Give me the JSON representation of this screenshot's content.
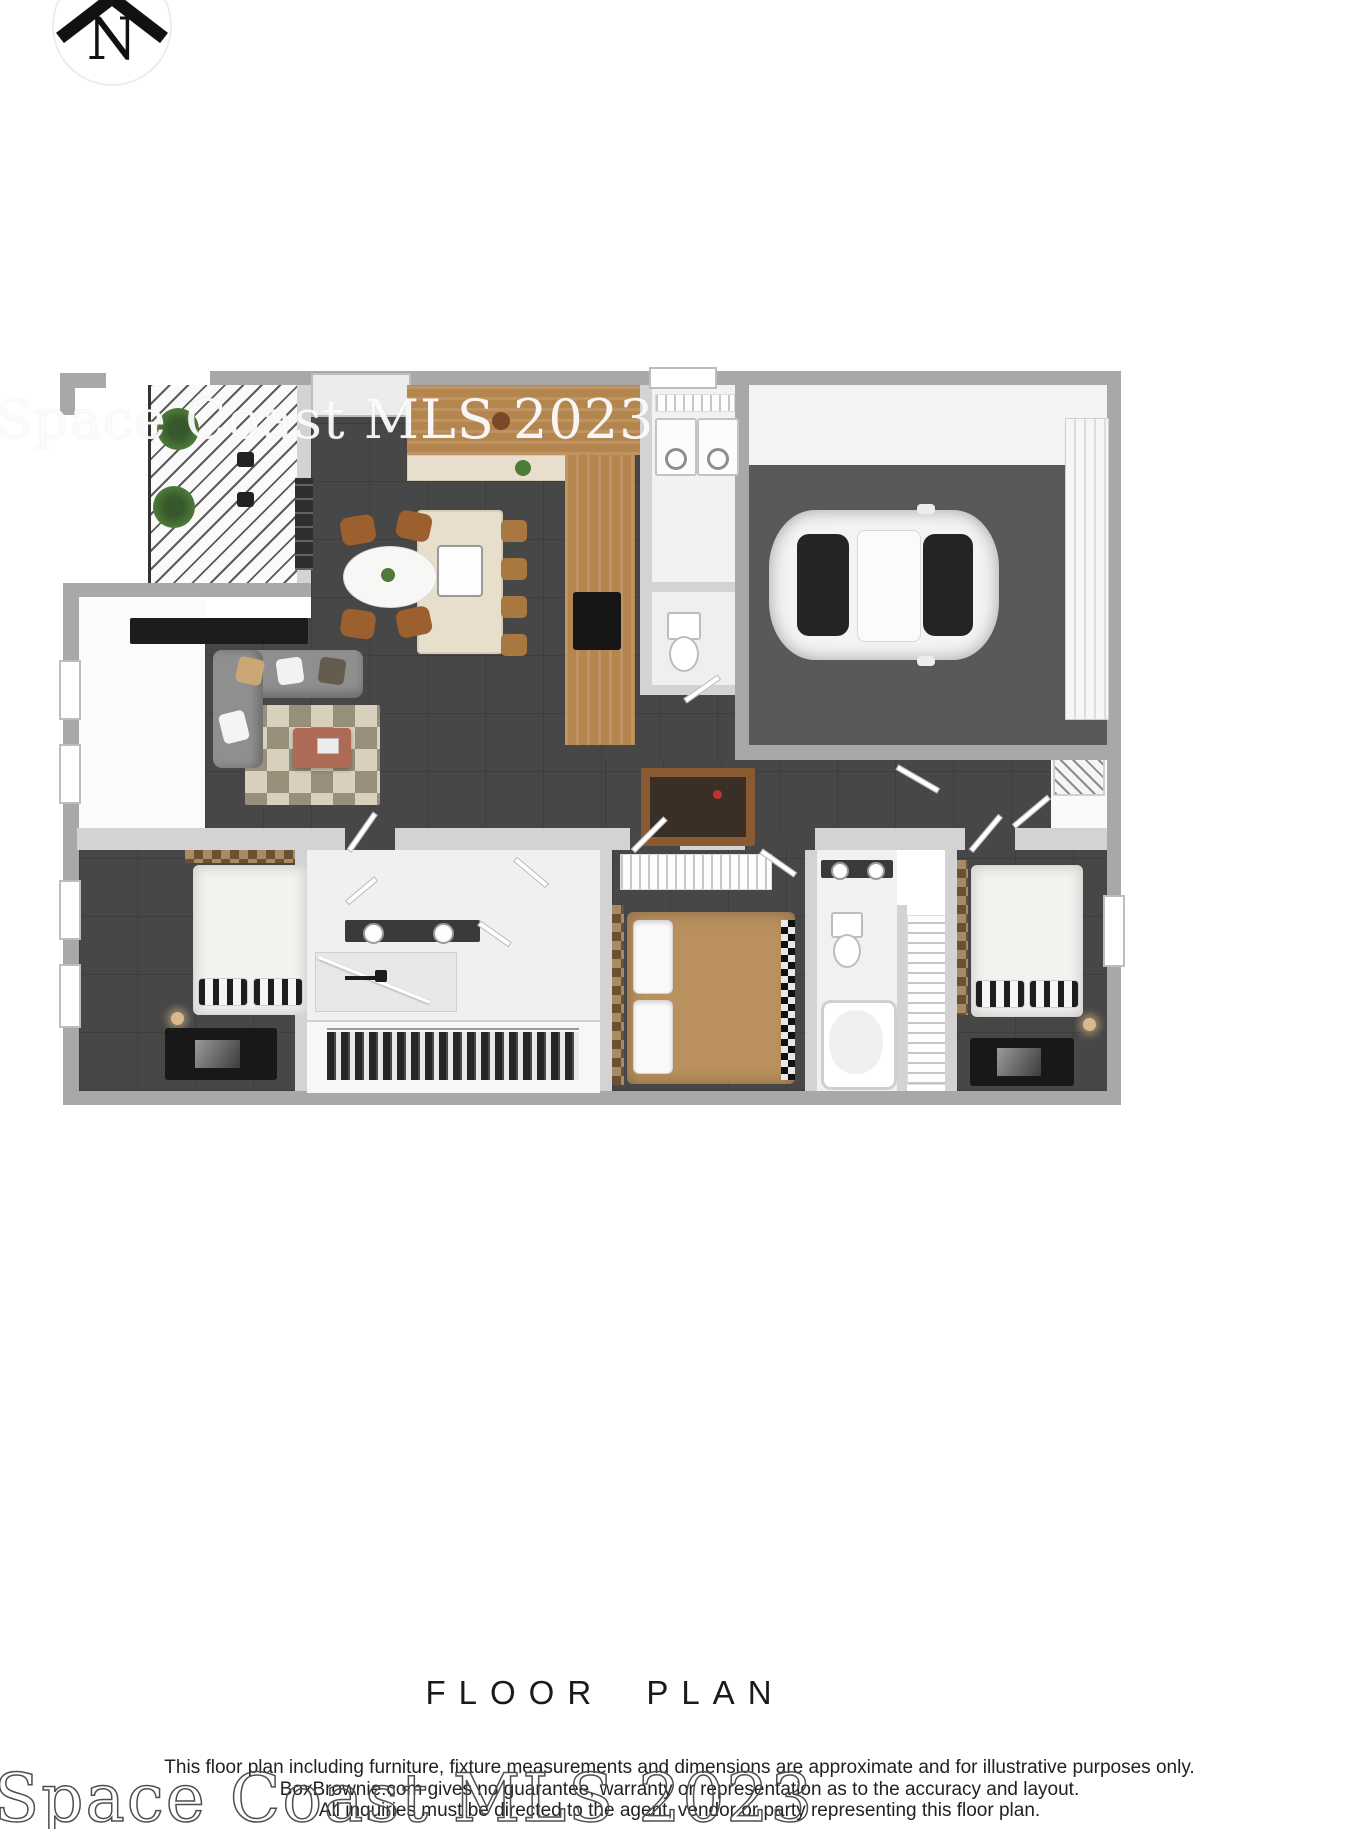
{
  "north": {
    "label": "N"
  },
  "title": "FLOOR PLAN",
  "watermark": {
    "text": "Space Coast MLS 2023"
  },
  "disclaimer": {
    "line1": "This floor plan including furniture, fixture measurements and dimensions are approximate and for illustrative purposes only.",
    "line2": "BoxBrownie.com gives no guarantee, warranty or representation as to the accuracy and layout.",
    "line3": "All inquiries must be directed to the agent, vendor or party representing this floor plan."
  },
  "colors": {
    "background": "#ffffff",
    "outer_wall": "#a8a8a8",
    "interior_wall": "#d3d3d3",
    "floor_dark": "#474747",
    "garage_floor": "#595959",
    "wood": "#b5854e",
    "island_counter": "#e7dfcc",
    "sofa": "#8f8f8f",
    "dining_chair": "#9c5f2e",
    "bed_tan": "#b9905e",
    "coffee_table": "#ad6a55",
    "text": "#1d1d1d"
  },
  "icons": {
    "north_icon": "north-compass-icon"
  }
}
